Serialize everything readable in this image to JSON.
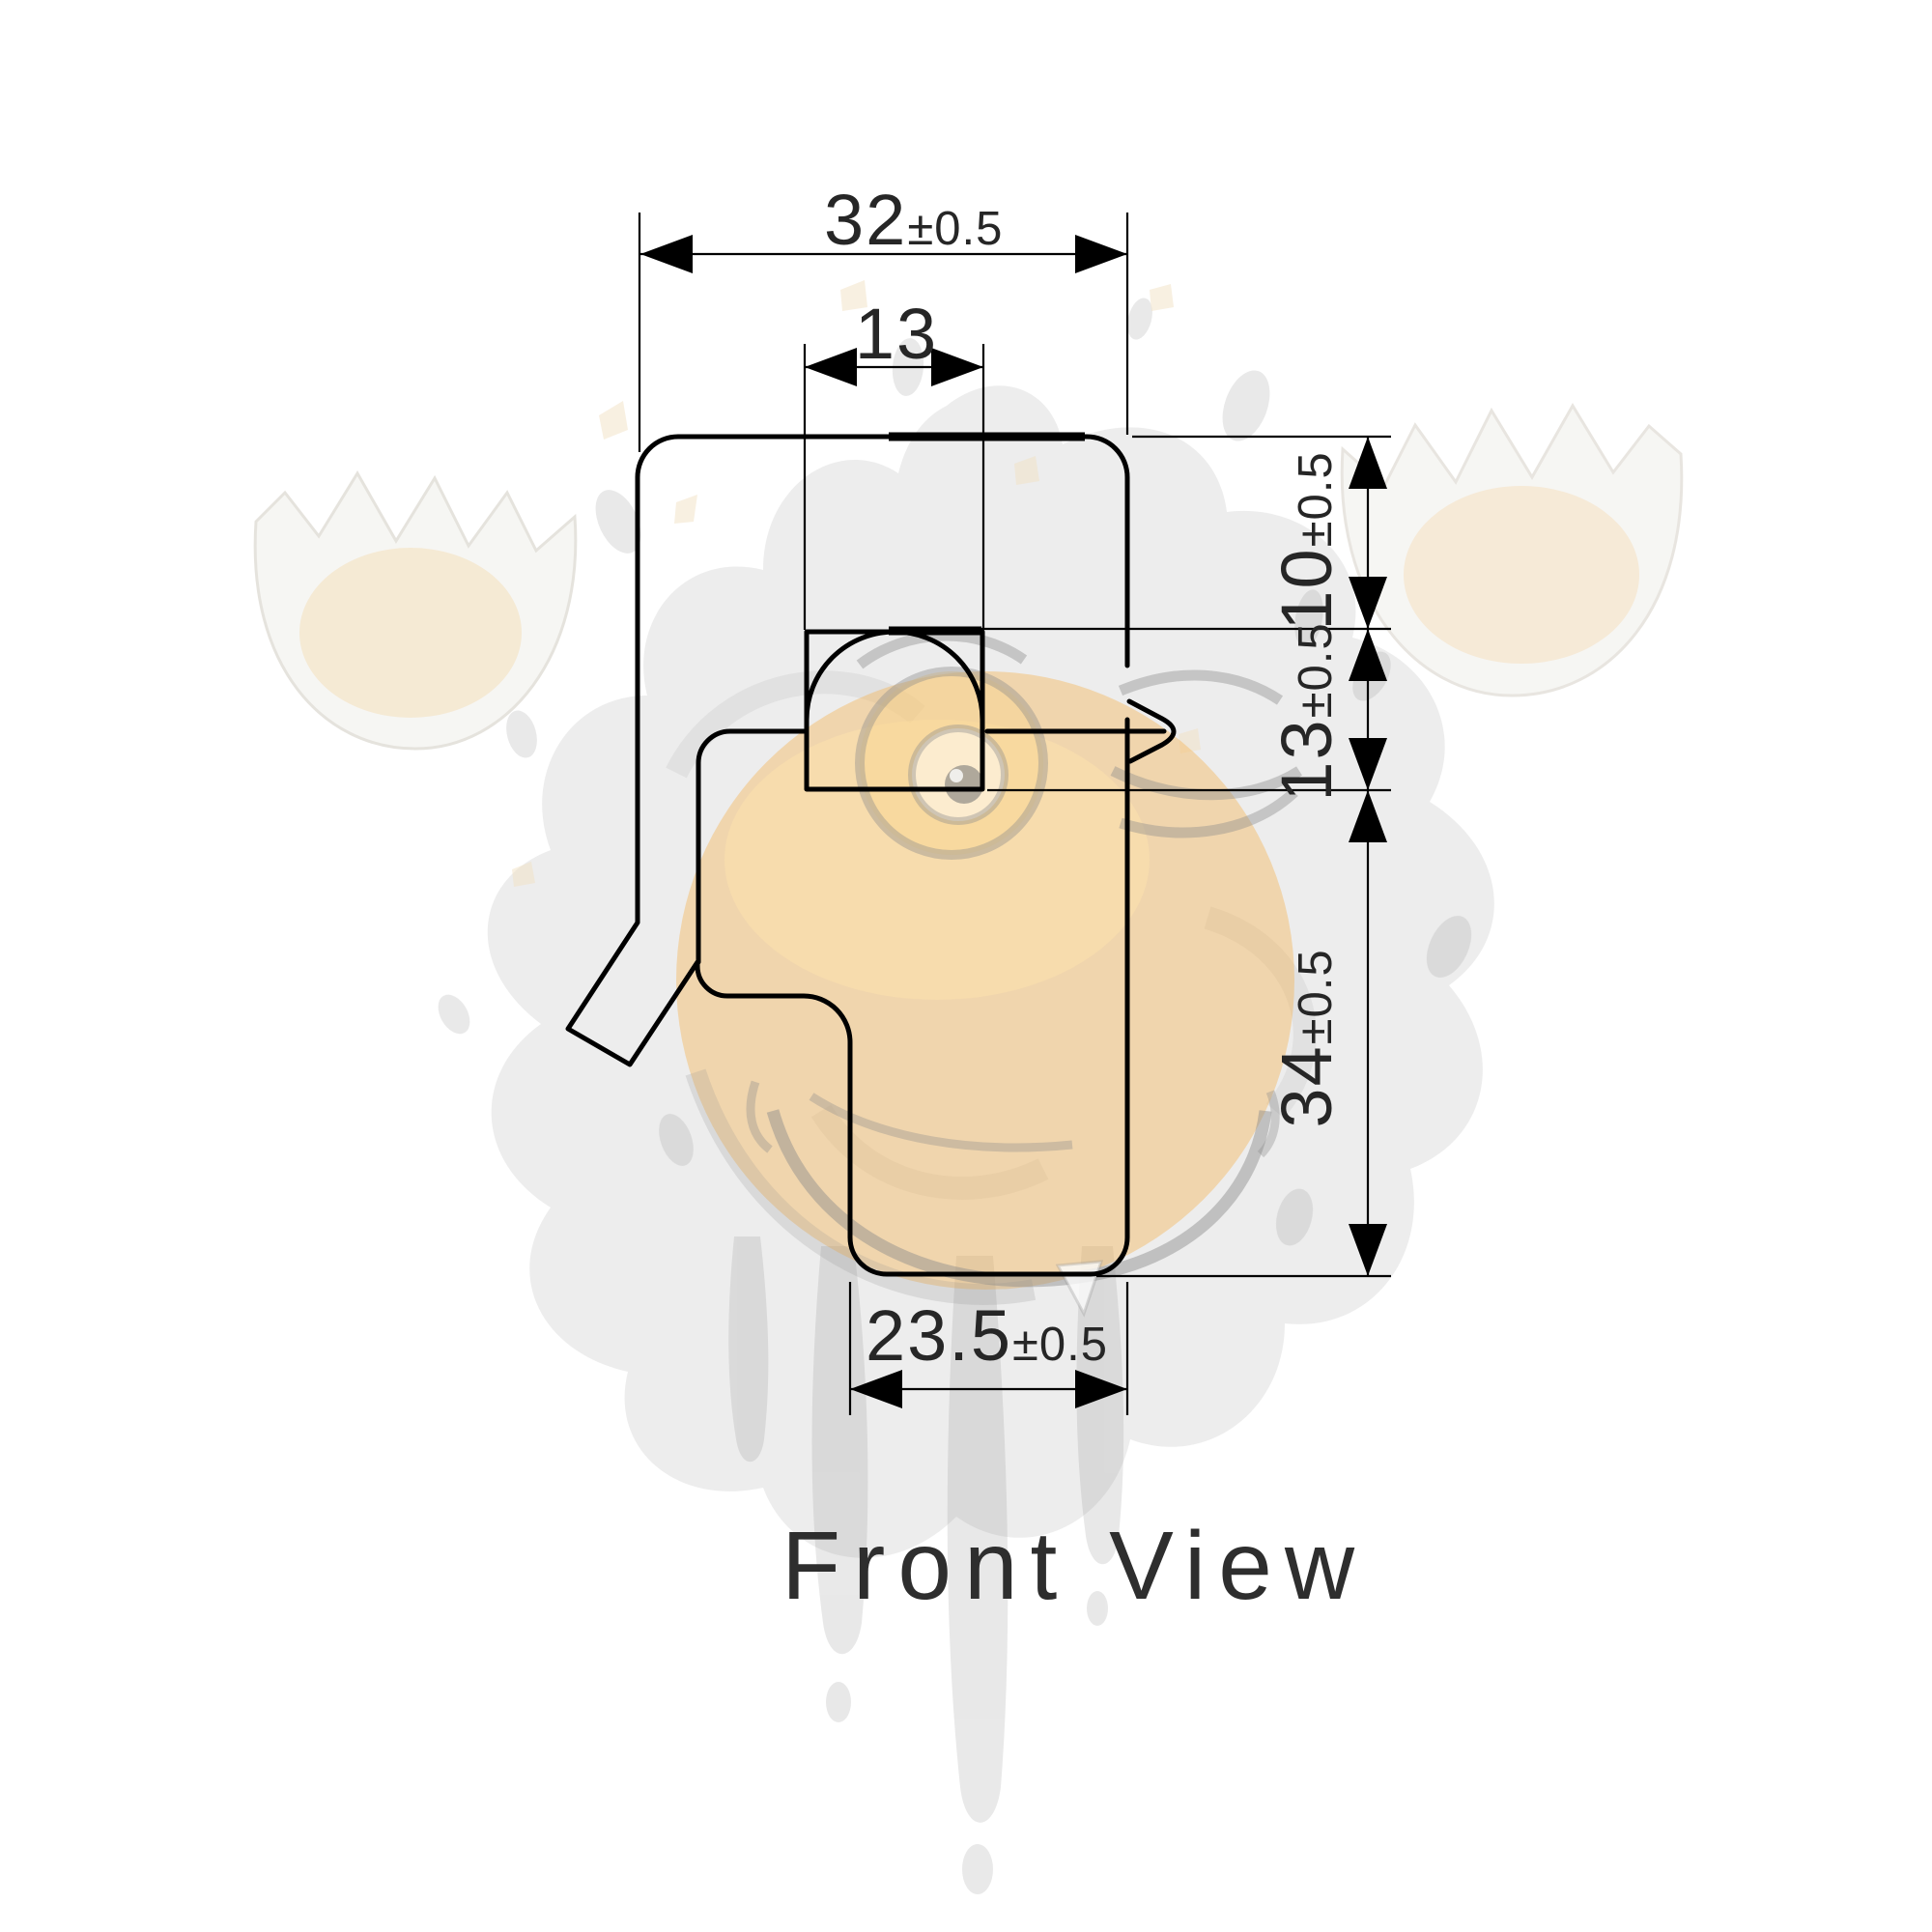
{
  "drawing": {
    "view_label": "Front View",
    "dimensions": {
      "top_width": {
        "value": "32",
        "tolerance": "±0.5"
      },
      "slot_width": {
        "value": "13",
        "tolerance": ""
      },
      "upper_height": {
        "value": "10",
        "tolerance": "±0.5"
      },
      "middle_height": {
        "value": "13",
        "tolerance": "±0.5"
      },
      "lower_height": {
        "value": "34",
        "tolerance": "±0.5"
      },
      "bottom_width": {
        "value": "23.5",
        "tolerance": "±0.5"
      }
    },
    "colors": {
      "line": "#000000",
      "text": "#262626",
      "background": "#ffffff",
      "watermark_gray": "#8f8f8f",
      "watermark_yolk": "#f5b656",
      "watermark_shell_tan": "#f3dcb4"
    }
  }
}
